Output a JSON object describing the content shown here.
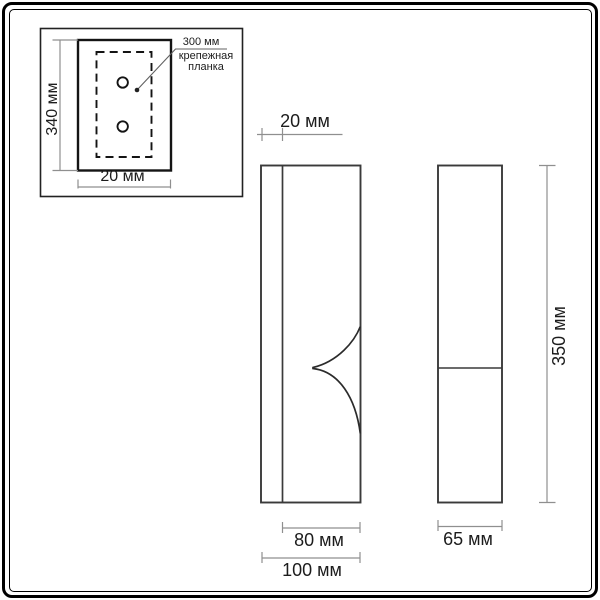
{
  "page": {
    "type": "technical-dimension-drawing",
    "subject": "wall sconce luminaire with mounting plate"
  },
  "colors": {
    "background": "#ffffff",
    "frame": "#000000",
    "outline": "#3a3a3a",
    "plate_outline": "#141414",
    "dimension_line": "#8f8f8f",
    "text": "#1c1c1c"
  },
  "inset_view": {
    "plate_height": "340 мм",
    "plate_width": "20 мм",
    "annotation_value": "300 мм",
    "annotation_caption_line1": "крепежная",
    "annotation_caption_line2": "планка"
  },
  "front_view": {
    "backplate_thickness": "20 мм",
    "body_width": "80 мм",
    "overall_width": "100 мм"
  },
  "side_view": {
    "depth": "65 мм",
    "height": "350 мм"
  }
}
